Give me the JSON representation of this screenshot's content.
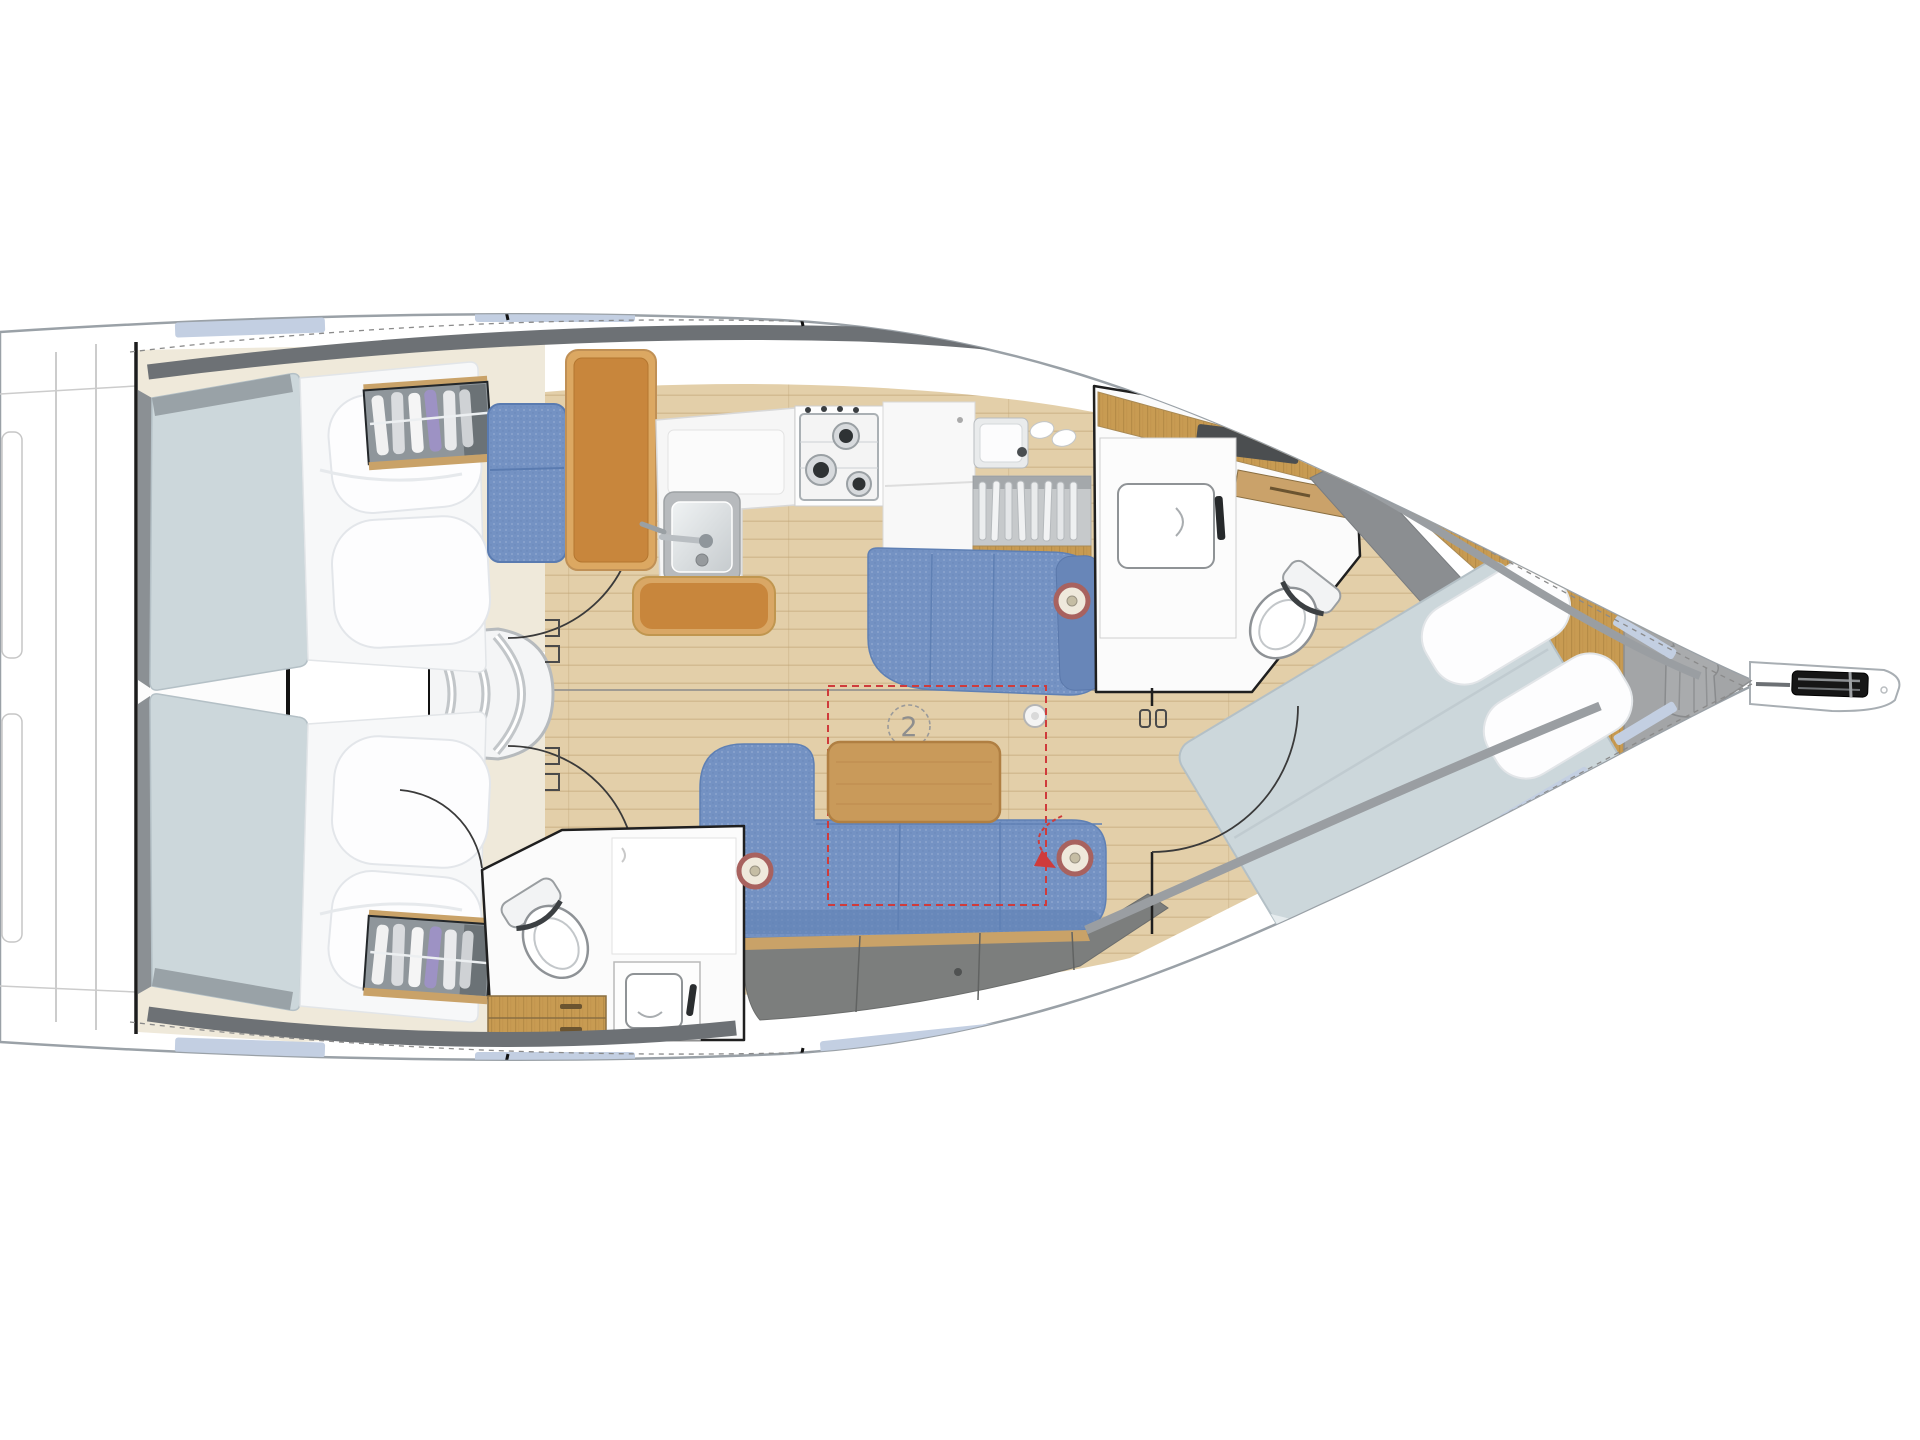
{
  "page": {
    "background": "#ffffff"
  },
  "floorplan": {
    "berth_marker": "2",
    "speaker_count": 3,
    "colors": {
      "hull_outline": "#9aa1a7",
      "deck_band": "#6d7175",
      "window_blue": "#c3cfe2",
      "floor_wood": "#e3cfa9",
      "cabinet_wood": "#c89b52",
      "table_wood": "#c99a5a",
      "leather_orange": "#c8863c",
      "upholstery_blue": "#7492c3",
      "upholstery_blue_dark": "#5f80b4",
      "mattress_gray": "#ccd7db",
      "duvet_white": "#f7f8f9",
      "locker_gray": "#7c7e7d",
      "anchor_gray": "#a3a5a7",
      "accent_red": "#cf3b3b",
      "marker_gray": "#8e8e8e"
    }
  }
}
